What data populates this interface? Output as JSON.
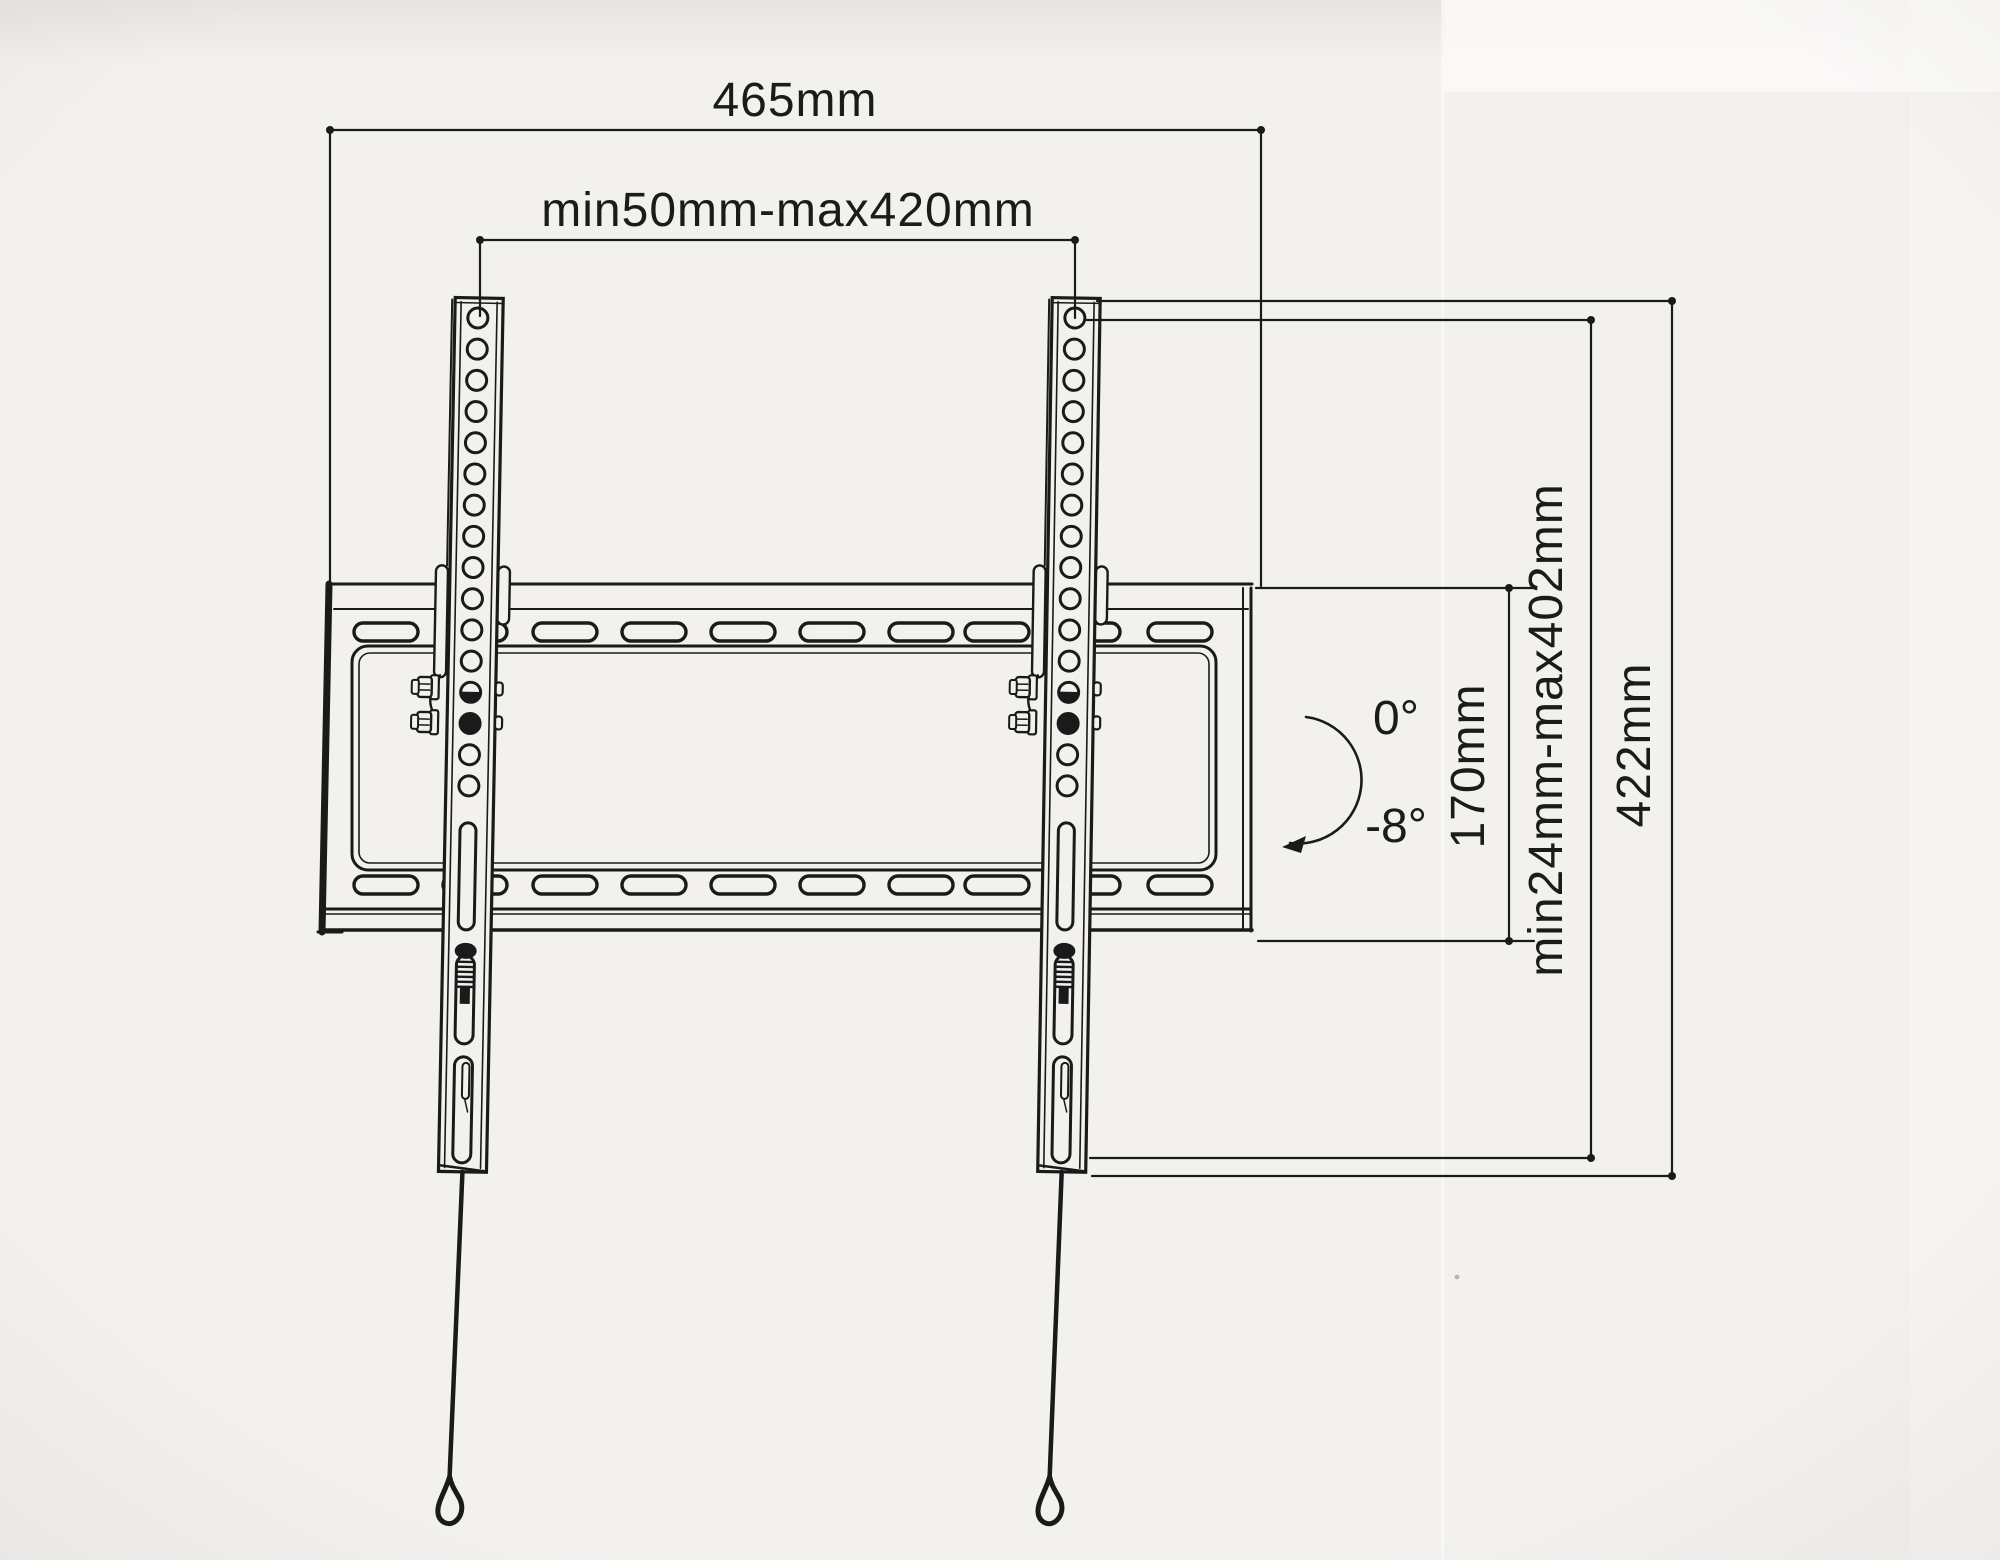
{
  "drawing": {
    "name": "tv-wall-mount-technical-drawing",
    "dimensions": {
      "plate_width": "465mm",
      "horizontal_range": "min50mm-max420mm",
      "plate_height": "170mm",
      "vertical_range": "min24mm-max402mm",
      "arm_height": "422mm"
    },
    "tilt": {
      "upper": "0°",
      "lower": "-8°"
    },
    "colors": {
      "ink": "#1a1a1a",
      "paper": "#f3f1ee"
    }
  }
}
